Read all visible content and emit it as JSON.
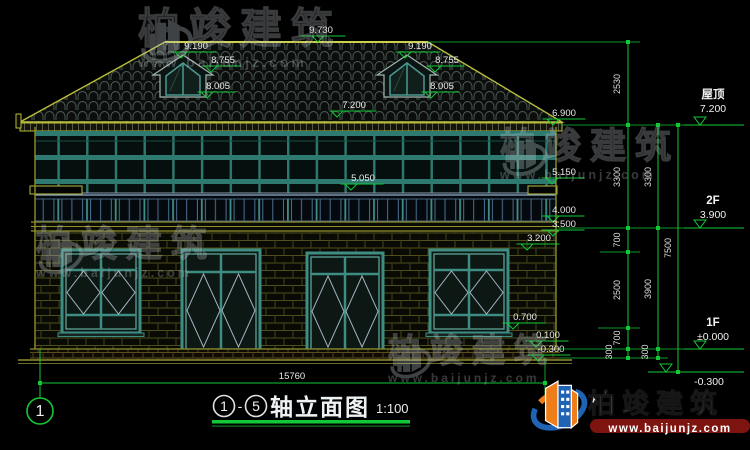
{
  "watermark": {
    "brand": "柏竣建筑",
    "url": "www.baijunjz.com"
  },
  "marks": {
    "ridge": "9.730",
    "dormer_apex": "9.190",
    "dormer_eave": "8.755",
    "dormer_sill": "8.005",
    "roof_mid": "7.200",
    "eave": "6.900",
    "f2_sill": "5.050",
    "f2_ledge": "5.150",
    "rail_bottom": "4.000",
    "slab": "3.500",
    "win_head": "3.200",
    "win_sill": "0.700",
    "plinth_top": "0.100",
    "ground": "-0.300"
  },
  "levels": {
    "roof_label": "屋顶",
    "roof_value": "7.200",
    "f2_label": "2F",
    "f2_value": "3.900",
    "f1_label": "1F",
    "f1_value": "±0.000",
    "ground_value": "-0.300"
  },
  "dims": {
    "chain_inner": [
      "2530",
      "3300",
      "700",
      "2500",
      "700",
      "300"
    ],
    "chain_mid": [
      "3300",
      "3900",
      "300"
    ],
    "chain_outer": "7500",
    "total_width": "15760"
  },
  "title": {
    "axis_start": "1",
    "dash": "-",
    "axis_end": "5",
    "name": "轴立面图",
    "scale": "1:100",
    "bubble": "1"
  }
}
